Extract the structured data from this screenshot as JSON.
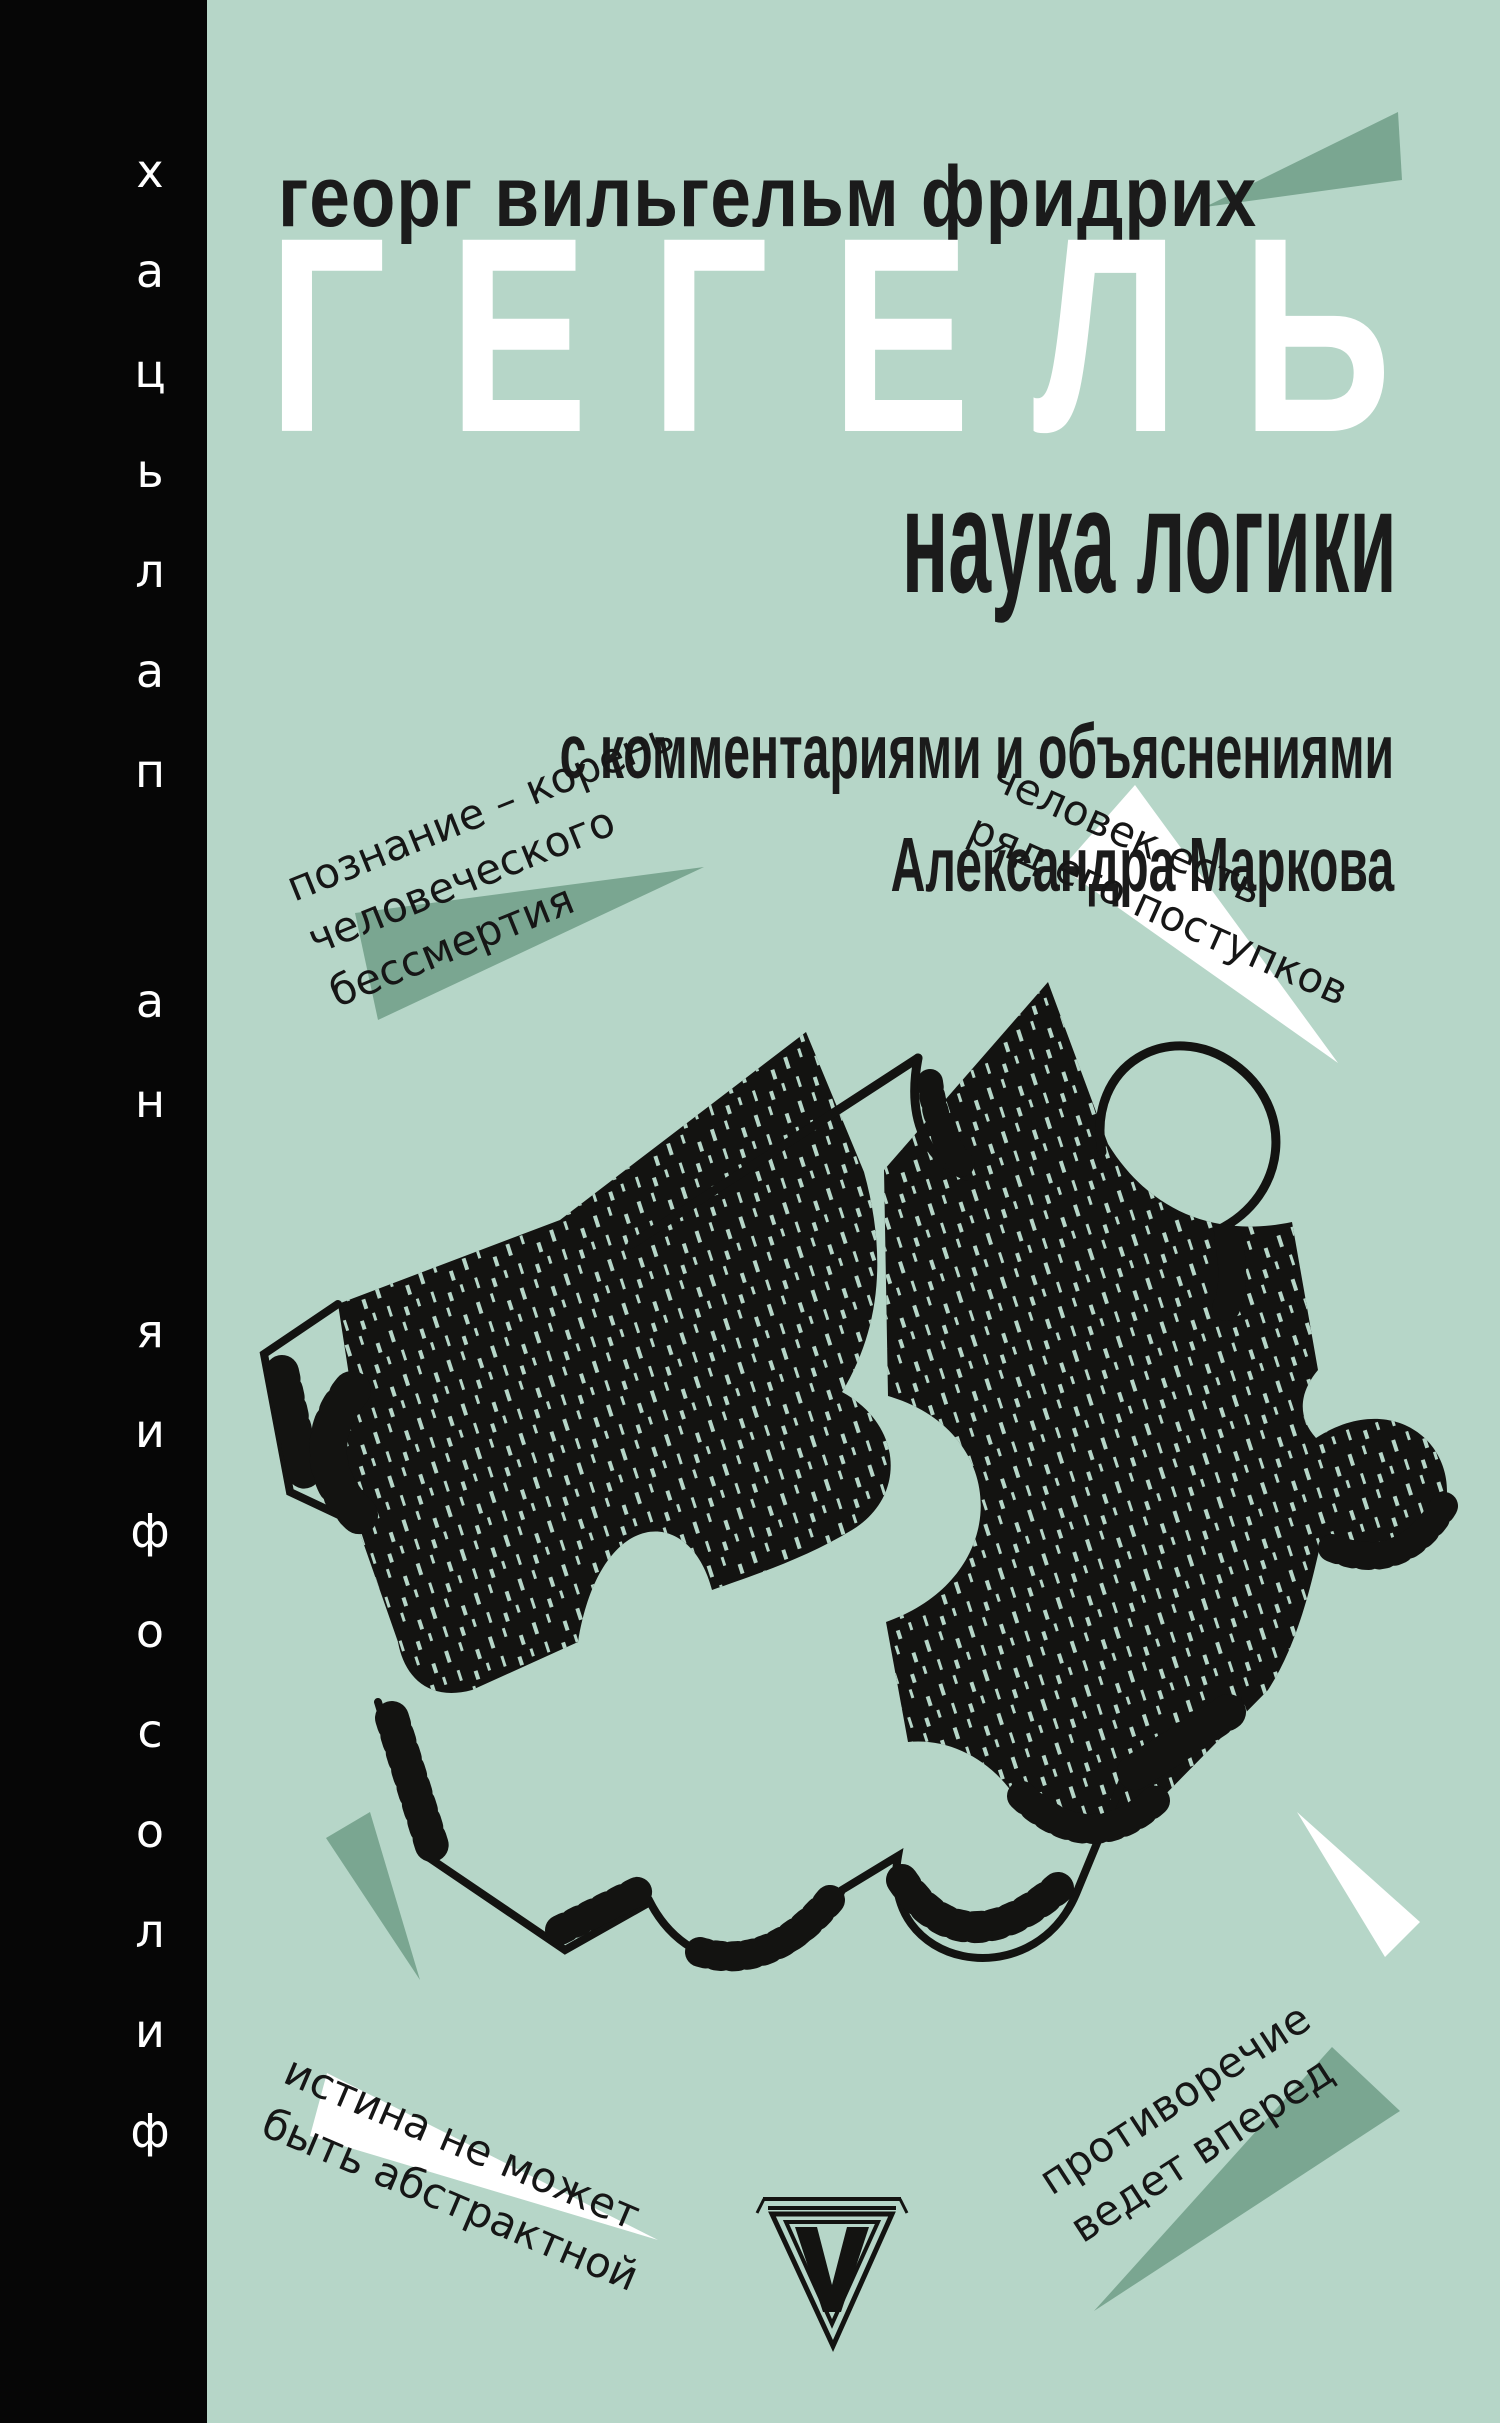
{
  "series": {
    "vertical_label": "философия на пальцах"
  },
  "author_line": "георг вильгельм фридрих",
  "title": "ГЕГЕЛЬ",
  "subtitle": "наука логики",
  "commentary": {
    "line1": "с комментариями и объяснениями",
    "line2": "Александра Маркова"
  },
  "quotes": [
    {
      "lines": [
        "познание – корень",
        "человеческого",
        "бессмертия"
      ]
    },
    {
      "lines": [
        "человек есть",
        "ряд его поступков"
      ]
    },
    {
      "lines": [
        "истина не может",
        "быть абстрактной"
      ]
    },
    {
      "lines": [
        "противоречие",
        "ведет вперед"
      ]
    }
  ],
  "icons": {
    "publisher_logo": "v-in-triangle",
    "illustration": "interlocking-hand-drawn-puzzle-pieces"
  },
  "colors": {
    "background": "#b6d6c8",
    "sidebar": "#060606",
    "accent_triangle": "#7aa691",
    "ink": "#131311",
    "white": "#ffffff",
    "text": "#1b1b1b"
  }
}
